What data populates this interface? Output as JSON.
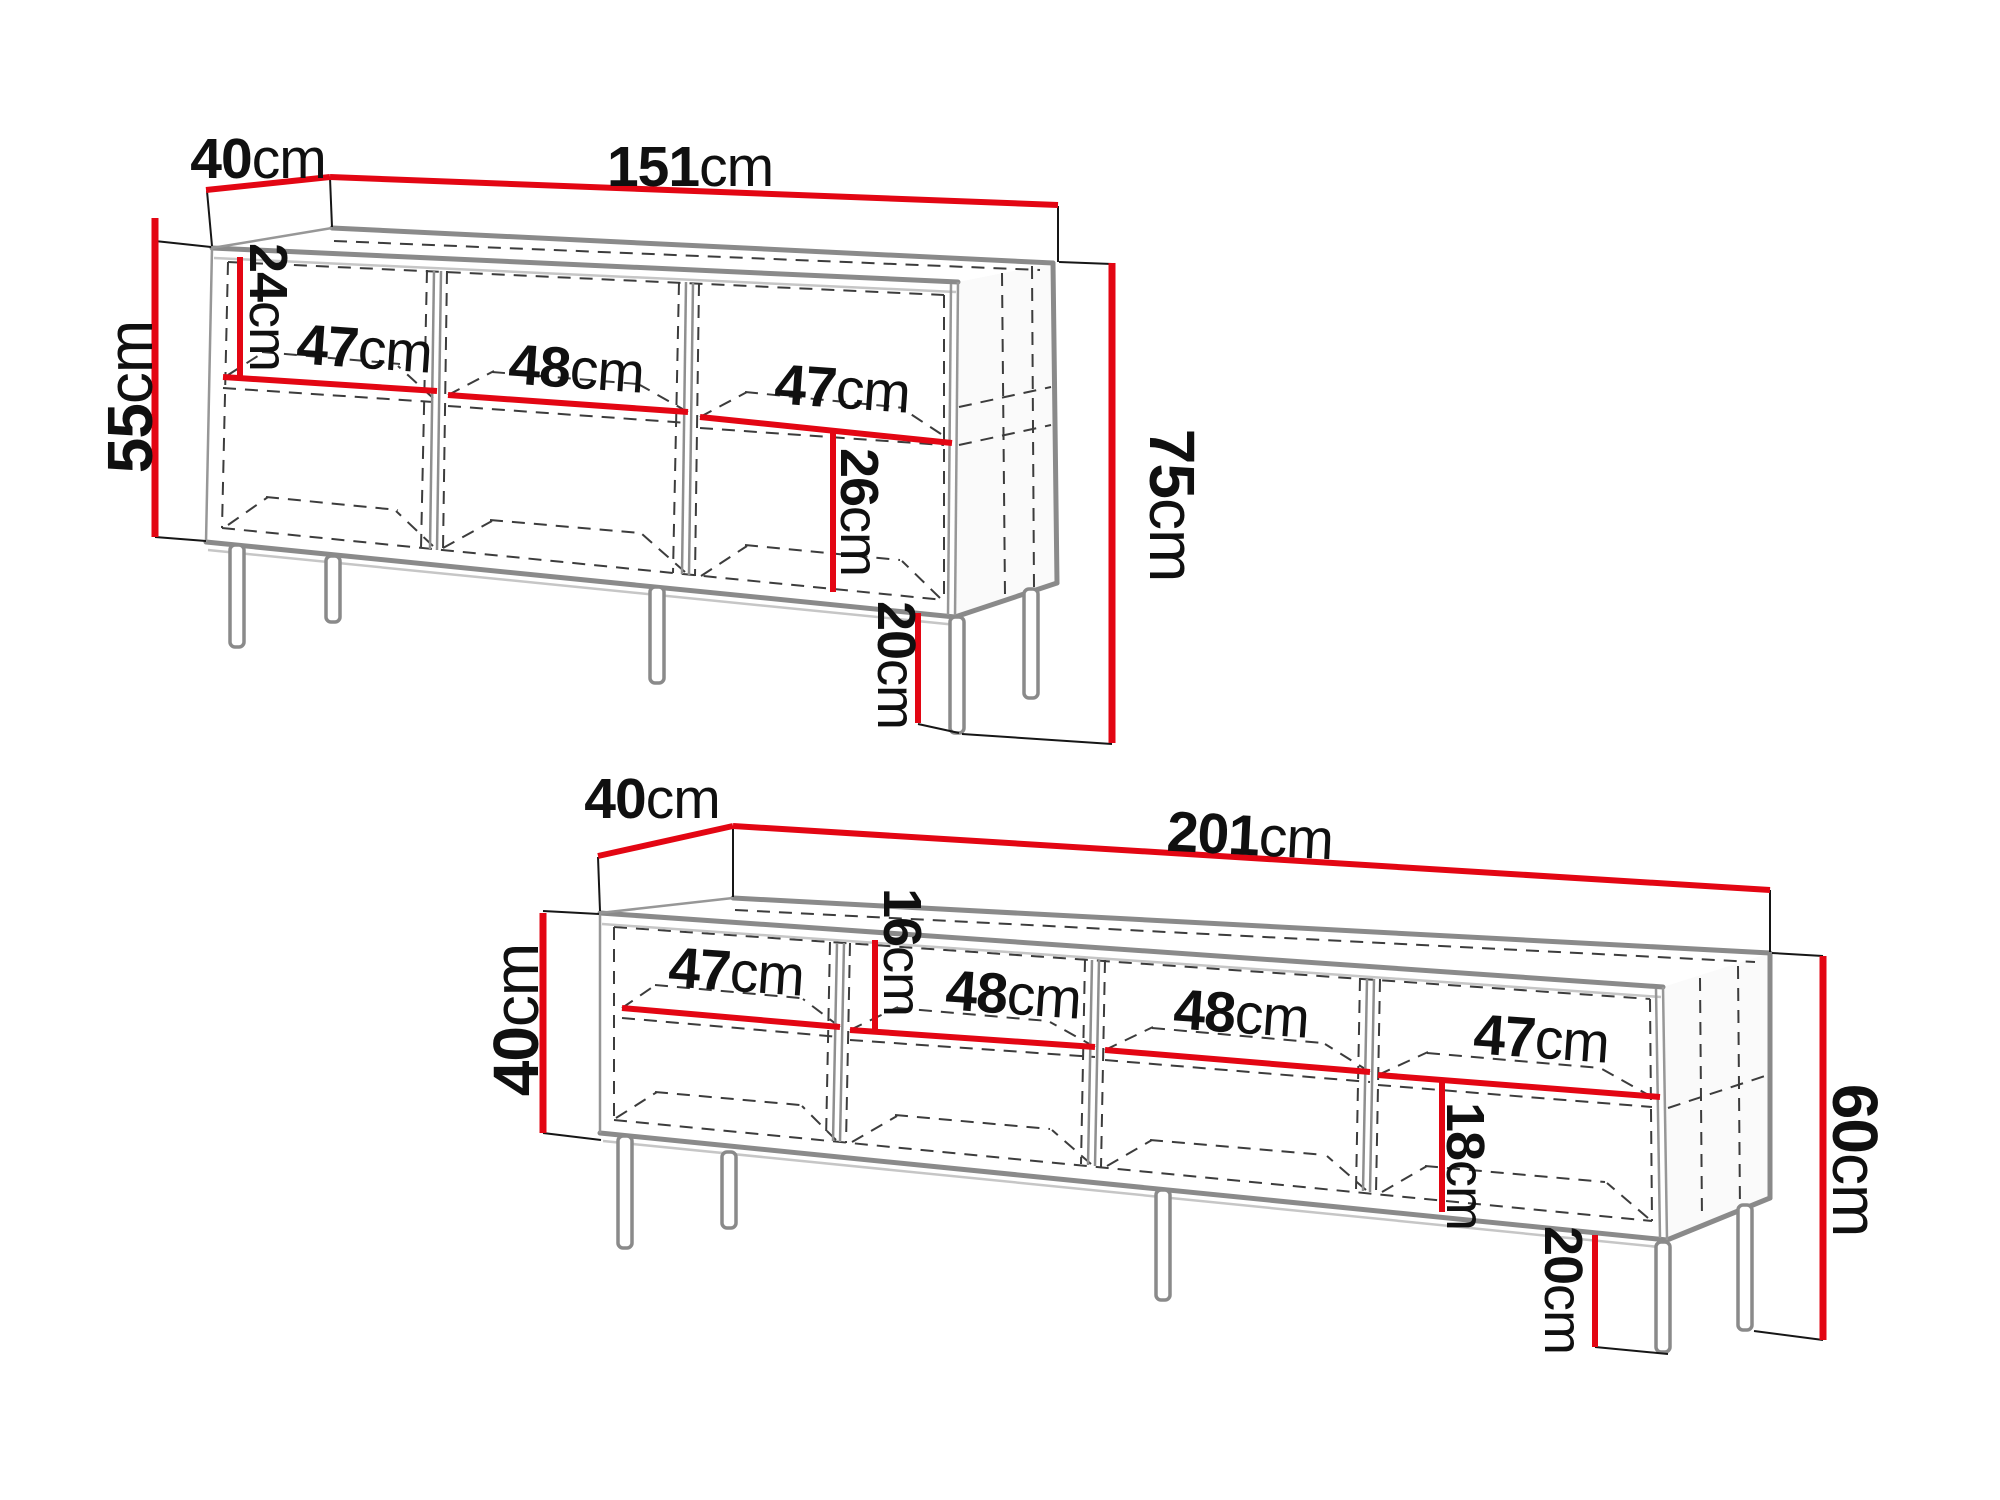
{
  "unit": "cm",
  "colors": {
    "dimension_red": "#e30613",
    "edge_gray": "#8a8a8a",
    "hidden_line_gray": "#3c3c3c",
    "text_black": "#101010",
    "background": "#ffffff"
  },
  "diagrams": [
    {
      "name": "sideboard",
      "labels": {
        "depth": {
          "value": "40",
          "unit": "cm"
        },
        "width": {
          "value": "151",
          "unit": "cm"
        },
        "body_height": {
          "value": "55",
          "unit": "cm"
        },
        "total_height": {
          "value": "75",
          "unit": "cm"
        },
        "top_compartment_height": {
          "value": "24",
          "unit": "cm"
        },
        "bottom_compartment_height": {
          "value": "26",
          "unit": "cm"
        },
        "leg_height": {
          "value": "20",
          "unit": "cm"
        },
        "compartment_widths": [
          {
            "value": "47",
            "unit": "cm"
          },
          {
            "value": "48",
            "unit": "cm"
          },
          {
            "value": "47",
            "unit": "cm"
          }
        ]
      }
    },
    {
      "name": "tv-stand",
      "labels": {
        "depth": {
          "value": "40",
          "unit": "cm"
        },
        "width": {
          "value": "201",
          "unit": "cm"
        },
        "body_height": {
          "value": "40",
          "unit": "cm"
        },
        "total_height": {
          "value": "60",
          "unit": "cm"
        },
        "top_compartment_height": {
          "value": "16",
          "unit": "cm"
        },
        "bottom_compartment_height": {
          "value": "18",
          "unit": "cm"
        },
        "leg_height": {
          "value": "20",
          "unit": "cm"
        },
        "compartment_widths": [
          {
            "value": "47",
            "unit": "cm"
          },
          {
            "value": "48",
            "unit": "cm"
          },
          {
            "value": "48",
            "unit": "cm"
          },
          {
            "value": "47",
            "unit": "cm"
          }
        ]
      }
    }
  ]
}
